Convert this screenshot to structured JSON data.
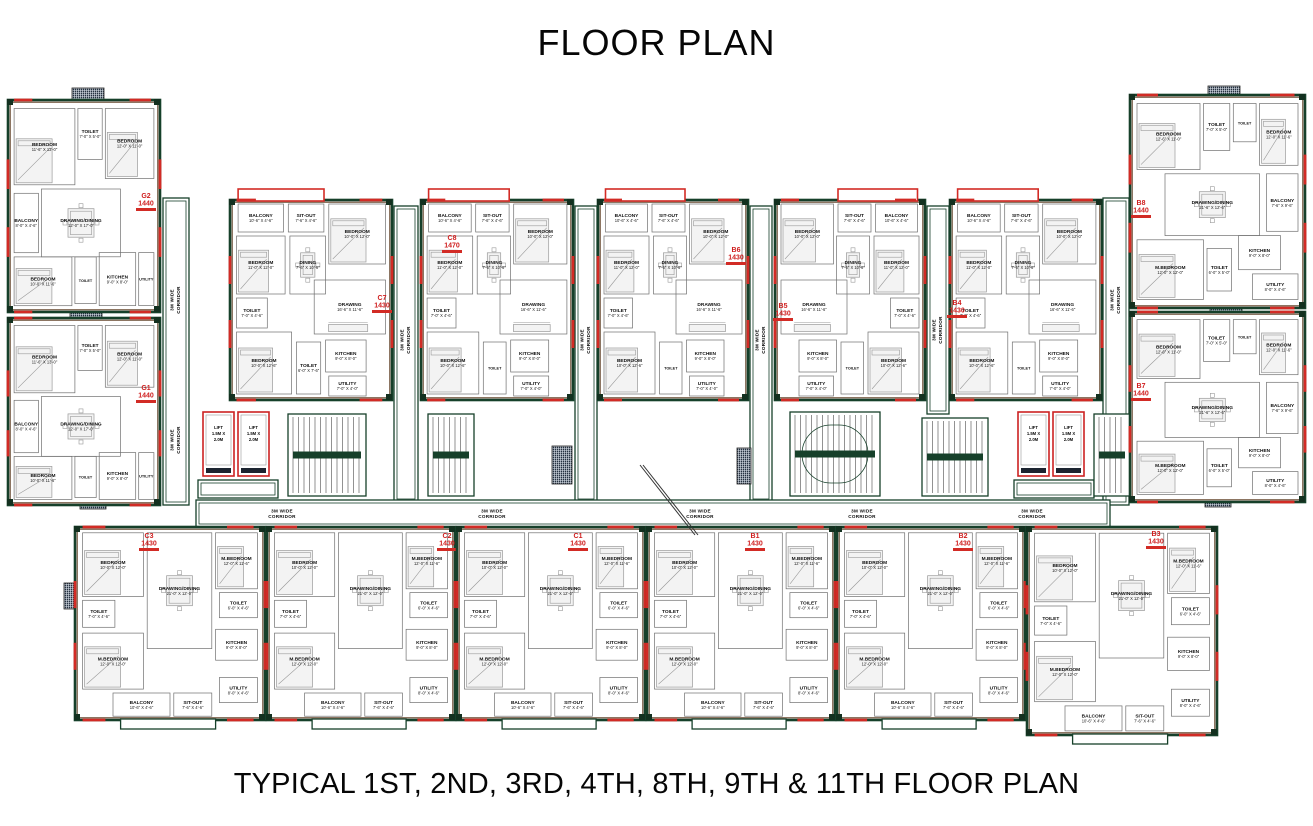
{
  "title": "FLOOR PLAN",
  "caption": "TYPICAL 1ST, 2ND, 3RD, 4TH, 8TH, 9TH & 11TH FLOOR PLAN",
  "colors": {
    "wall_green": "#16402a",
    "wall_brown": "#5a3a20",
    "accent_red": "#d22b25",
    "tag_red": "#cf1d1d",
    "furniture_gray": "#9a9a9a",
    "shaft_dark": "#243040"
  },
  "plan": {
    "corridor_label_lines": [
      "3M WIDE",
      "CORRIDOR"
    ],
    "lift_label_lines": [
      "LIFT",
      "1.5M X",
      "2.0M"
    ],
    "unit_types": {
      "cornerL": {
        "rooms": [
          {
            "n": "BEDROOM",
            "d": "11'-6\" X 13'-0\"",
            "r": [
              0.04,
              0.04,
              0.4,
              0.36
            ],
            "f": "bed"
          },
          {
            "n": "TOILET",
            "d": "7'-0\" X 5'-0\"",
            "r": [
              0.46,
              0.04,
              0.16,
              0.24
            ]
          },
          {
            "n": "BEDROOM",
            "d": "12'-0\" X 11'-0\"",
            "r": [
              0.64,
              0.04,
              0.32,
              0.33
            ],
            "f": "bed"
          },
          {
            "n": "BALCONY",
            "d": "8'-0\" X 4'-6\"",
            "r": [
              0.04,
              0.44,
              0.16,
              0.28
            ]
          },
          {
            "n": "DRAWING/DINING",
            "d": "12'-0\" X 17'-0\"",
            "r": [
              0.22,
              0.42,
              0.52,
              0.32
            ],
            "f": "table"
          },
          {
            "n": "BEDROOM",
            "d": "10'-0\" X 11'-6\"",
            "r": [
              0.04,
              0.74,
              0.38,
              0.23
            ],
            "f": "bed"
          },
          {
            "n": "TOILET",
            "d": "6'-0\" X 5'-0\"",
            "r": [
              0.44,
              0.74,
              0.14,
              0.22
            ]
          },
          {
            "n": "KITCHEN",
            "d": "9'-0\" X 8'-0\"",
            "r": [
              0.6,
              0.72,
              0.24,
              0.25
            ]
          },
          {
            "n": "UTILITY",
            "d": "8'-0\" X 4'-0\"",
            "r": [
              0.86,
              0.72,
              0.1,
              0.25
            ]
          }
        ]
      },
      "cornerR": {
        "rooms": [
          {
            "n": "BEDROOM",
            "d": "12'-6\" X 11'-0\"",
            "r": [
              0.04,
              0.04,
              0.36,
              0.31
            ],
            "f": "bed"
          },
          {
            "n": "TOILET",
            "d": "7'-0\" X 5'-0\"",
            "r": [
              0.42,
              0.04,
              0.15,
              0.22
            ]
          },
          {
            "n": "TOILET",
            "d": "5'-0\" X 5'-0\"",
            "r": [
              0.59,
              0.04,
              0.13,
              0.18
            ]
          },
          {
            "n": "BEDROOM",
            "d": "12'-0\" X 11'-6\"",
            "r": [
              0.74,
              0.04,
              0.22,
              0.29
            ],
            "f": "bed"
          },
          {
            "n": "DRAWING/DINING",
            "d": "21'-6\" X 12'-6\"",
            "r": [
              0.2,
              0.37,
              0.54,
              0.29
            ],
            "f": "table"
          },
          {
            "n": "BALCONY",
            "d": "7'-6\" X 9'-6\"",
            "r": [
              0.78,
              0.37,
              0.18,
              0.27
            ]
          },
          {
            "n": "M.BEDROOM",
            "d": "12'-0\" X 12'-0\"",
            "r": [
              0.04,
              0.68,
              0.38,
              0.28
            ],
            "f": "bed"
          },
          {
            "n": "TOILET",
            "d": "6'-0\" X 5'-0\"",
            "r": [
              0.44,
              0.72,
              0.14,
              0.2
            ]
          },
          {
            "n": "KITCHEN",
            "d": "9'-0\" X 8'-0\"",
            "r": [
              0.62,
              0.66,
              0.24,
              0.16
            ]
          },
          {
            "n": "UTILITY",
            "d": "8'-0\" X 4'-6\"",
            "r": [
              0.7,
              0.84,
              0.26,
              0.12
            ]
          }
        ]
      },
      "topA": {
        "rooms": [
          {
            "n": "BALCONY",
            "d": "10'-6\" X 4'-6\"",
            "r": [
              0.05,
              0.02,
              0.28,
              0.14
            ]
          },
          {
            "n": "SIT-OUT",
            "d": "7'-6\" X 4'-6\"",
            "r": [
              0.36,
              0.02,
              0.22,
              0.14
            ]
          },
          {
            "n": "BEDROOM",
            "d": "10'-0\" X 12'-0\"",
            "r": [
              0.61,
              0.02,
              0.35,
              0.3
            ],
            "f": "bed"
          },
          {
            "n": "BEDROOM",
            "d": "11'-0\" X 12'-0\"",
            "r": [
              0.04,
              0.18,
              0.3,
              0.29
            ],
            "f": "bed"
          },
          {
            "n": "DINING",
            "d": "7'-6\" X 10'-6\"",
            "r": [
              0.37,
              0.18,
              0.22,
              0.29
            ],
            "f": "table"
          },
          {
            "n": "DRAWING",
            "d": "16'-6\" X 11'-6\"",
            "r": [
              0.52,
              0.4,
              0.44,
              0.27
            ],
            "f": "sofa"
          },
          {
            "n": "TOILET",
            "d": "7'-0\" X 4'-6\"",
            "r": [
              0.04,
              0.49,
              0.19,
              0.15
            ]
          },
          {
            "n": "BEDROOM",
            "d": "10'-0\" X 12'-6\"",
            "r": [
              0.04,
              0.66,
              0.34,
              0.31
            ],
            "f": "bed"
          },
          {
            "n": "TOILET",
            "d": "6'-0\" X 7'-6\"",
            "r": [
              0.41,
              0.71,
              0.15,
              0.26
            ]
          },
          {
            "n": "KITCHEN",
            "d": "9'-0\" X 8'-0\"",
            "r": [
              0.59,
              0.7,
              0.25,
              0.16
            ]
          },
          {
            "n": "UTILITY",
            "d": "7'-0\" X 4'-0\"",
            "r": [
              0.61,
              0.88,
              0.23,
              0.1
            ]
          }
        ]
      },
      "botA": {
        "rooms": [
          {
            "n": "BEDROOM",
            "d": "10'-0\" X 12'-0\"",
            "r": [
              0.04,
              0.03,
              0.32,
              0.33
            ],
            "f": "bed"
          },
          {
            "n": "DRAWING/DINING",
            "d": "21'-0\" X 12'-0\"",
            "r": [
              0.38,
              0.03,
              0.34,
              0.6
            ],
            "f": "table"
          },
          {
            "n": "M.BEDROOM",
            "d": "12'-0\" X 11'-6\"",
            "r": [
              0.74,
              0.03,
              0.22,
              0.29
            ],
            "f": "bed"
          },
          {
            "n": "TOILET",
            "d": "7'-0\" X 4'-6\"",
            "r": [
              0.04,
              0.38,
              0.17,
              0.14
            ]
          },
          {
            "n": "TOILET",
            "d": "6'-0\" X 4'-6\"",
            "r": [
              0.76,
              0.34,
              0.2,
              0.13
            ]
          },
          {
            "n": "M.BEDROOM",
            "d": "12'-0\" X 12'-0\"",
            "r": [
              0.04,
              0.55,
              0.32,
              0.29
            ],
            "f": "bed"
          },
          {
            "n": "KITCHEN",
            "d": "9'-0\" X 8'-0\"",
            "r": [
              0.74,
              0.53,
              0.22,
              0.16
            ]
          },
          {
            "n": "UTILITY",
            "d": "8'-0\" X 4'-6\"",
            "r": [
              0.76,
              0.78,
              0.2,
              0.13
            ]
          },
          {
            "n": "BALCONY",
            "d": "10'-6\" X 4'-6\"",
            "r": [
              0.2,
              0.86,
              0.3,
              0.12
            ]
          },
          {
            "n": "SIT-OUT",
            "d": "7'-6\" X 4'-6\"",
            "r": [
              0.52,
              0.86,
              0.2,
              0.12
            ]
          }
        ]
      }
    },
    "units": [
      {
        "id": "LW-A",
        "type": "cornerL",
        "x": 8,
        "y": 100,
        "w": 152,
        "h": 212,
        "tag": {
          "code": "G2",
          "area": "1440",
          "tx": 146,
          "ty": 198
        }
      },
      {
        "id": "LW-B",
        "type": "cornerL",
        "x": 8,
        "y": 318,
        "w": 152,
        "h": 187,
        "tag": {
          "code": "G1",
          "area": "1440",
          "tx": 146,
          "ty": 390
        }
      },
      {
        "id": "T1",
        "type": "topA",
        "x": 230,
        "y": 200,
        "w": 162,
        "h": 200,
        "tag": {
          "code": "C7",
          "area": "1430",
          "tx": 382,
          "ty": 300
        }
      },
      {
        "id": "T2",
        "type": "topA",
        "x": 421,
        "y": 200,
        "w": 152,
        "h": 200,
        "tag": {
          "code": "C8",
          "area": "1470",
          "tx": 452,
          "ty": 240
        }
      },
      {
        "id": "T3",
        "type": "topA",
        "x": 598,
        "y": 200,
        "w": 150,
        "h": 200,
        "tag": {
          "code": "B6",
          "area": "1430",
          "tx": 736,
          "ty": 252
        }
      },
      {
        "id": "T4",
        "type": "topA",
        "mirror": true,
        "x": 775,
        "y": 200,
        "w": 150,
        "h": 200,
        "tag": {
          "code": "B5",
          "area": "1430",
          "tx": 783,
          "ty": 308
        }
      },
      {
        "id": "T5",
        "type": "topA",
        "x": 950,
        "y": 200,
        "w": 152,
        "h": 200,
        "tag": {
          "code": "B4",
          "area": "1430",
          "tx": 957,
          "ty": 305
        }
      },
      {
        "id": "RW-A",
        "type": "cornerR",
        "x": 1130,
        "y": 95,
        "w": 175,
        "h": 213,
        "tag": {
          "code": "B8",
          "area": "1440",
          "tx": 1141,
          "ty": 205
        }
      },
      {
        "id": "RW-B",
        "type": "cornerR",
        "x": 1130,
        "y": 312,
        "w": 175,
        "h": 190,
        "tag": {
          "code": "B7",
          "area": "1440",
          "tx": 1141,
          "ty": 388
        }
      },
      {
        "id": "B1",
        "type": "botA",
        "x": 75,
        "y": 527,
        "w": 190,
        "h": 193,
        "tag": {
          "code": "C3",
          "area": "1430",
          "tx": 149,
          "ty": 538
        }
      },
      {
        "id": "B2",
        "type": "botA",
        "x": 267,
        "y": 527,
        "w": 188,
        "h": 193,
        "tag": {
          "code": "C2",
          "area": "1430",
          "tx": 447,
          "ty": 538
        }
      },
      {
        "id": "B3",
        "type": "botA",
        "x": 457,
        "y": 527,
        "w": 188,
        "h": 193,
        "tag": {
          "code": "C1",
          "area": "1430",
          "tx": 578,
          "ty": 538
        }
      },
      {
        "id": "B4",
        "type": "botA",
        "x": 647,
        "y": 527,
        "w": 188,
        "h": 193,
        "tag": {
          "code": "B1",
          "area": "1430",
          "tx": 755,
          "ty": 538
        }
      },
      {
        "id": "B5",
        "type": "botA",
        "x": 837,
        "y": 527,
        "w": 188,
        "h": 193,
        "tag": {
          "code": "B2",
          "area": "1430",
          "tx": 963,
          "ty": 538
        }
      },
      {
        "id": "B6",
        "type": "botA",
        "x": 1027,
        "y": 527,
        "w": 190,
        "h": 208,
        "tag": {
          "code": "B3",
          "area": "1430",
          "tx": 1156,
          "ty": 536
        }
      }
    ],
    "corridors": [
      {
        "x": 163,
        "y": 198,
        "w": 26,
        "h": 307,
        "o": "v",
        "labels": [
          300,
          440
        ]
      },
      {
        "x": 394,
        "y": 206,
        "w": 24,
        "h": 296,
        "o": "v",
        "labels": [
          340
        ]
      },
      {
        "x": 575,
        "y": 206,
        "w": 22,
        "h": 296,
        "o": "v",
        "labels": [
          340
        ]
      },
      {
        "x": 750,
        "y": 206,
        "w": 22,
        "h": 296,
        "o": "v",
        "labels": [
          340
        ]
      },
      {
        "x": 927,
        "y": 206,
        "w": 22,
        "h": 208,
        "o": "v",
        "labels": [
          330
        ]
      },
      {
        "x": 1103,
        "y": 198,
        "w": 26,
        "h": 307,
        "o": "v",
        "labels": [
          300,
          440
        ]
      },
      {
        "x": 196,
        "y": 500,
        "w": 914,
        "h": 27,
        "o": "h",
        "labels": [
          282,
          492,
          700,
          862,
          1032
        ]
      }
    ],
    "lifts": [
      [
        203,
        412,
        31,
        64
      ],
      [
        238,
        412,
        31,
        64
      ],
      [
        1018,
        412,
        31,
        64
      ],
      [
        1053,
        412,
        31,
        64
      ]
    ],
    "lobbies": [
      [
        198,
        480,
        80,
        18
      ],
      [
        1014,
        480,
        80,
        18
      ]
    ],
    "stairs": [
      {
        "x": 288,
        "y": 414,
        "w": 78,
        "h": 82
      },
      {
        "x": 428,
        "y": 414,
        "w": 46,
        "h": 82
      },
      {
        "x": 790,
        "y": 412,
        "w": 90,
        "h": 84,
        "oval": true
      },
      {
        "x": 922,
        "y": 418,
        "w": 66,
        "h": 78
      },
      {
        "x": 1094,
        "y": 414,
        "w": 36,
        "h": 82
      }
    ],
    "shafts": [
      [
        72,
        88,
        32,
        16
      ],
      [
        1208,
        86,
        32,
        16
      ],
      [
        70,
        304,
        32,
        14
      ],
      [
        1210,
        302,
        32,
        14
      ],
      [
        80,
        496,
        26,
        13
      ],
      [
        1205,
        494,
        26,
        13
      ],
      [
        64,
        583,
        14,
        26
      ],
      [
        256,
        583,
        18,
        26
      ],
      [
        446,
        583,
        18,
        26
      ],
      [
        636,
        583,
        18,
        26
      ],
      [
        826,
        583,
        18,
        26
      ],
      [
        1016,
        583,
        18,
        26
      ],
      [
        552,
        446,
        20,
        38
      ],
      [
        737,
        448,
        14,
        36
      ],
      [
        296,
        388,
        26,
        12
      ],
      [
        480,
        388,
        26,
        12
      ],
      [
        658,
        388,
        26,
        12
      ],
      [
        835,
        388,
        26,
        12
      ],
      [
        1010,
        388,
        26,
        12
      ]
    ],
    "section_line": {
      "x1": 640,
      "y1": 465,
      "x2": 695,
      "y2": 535
    }
  }
}
